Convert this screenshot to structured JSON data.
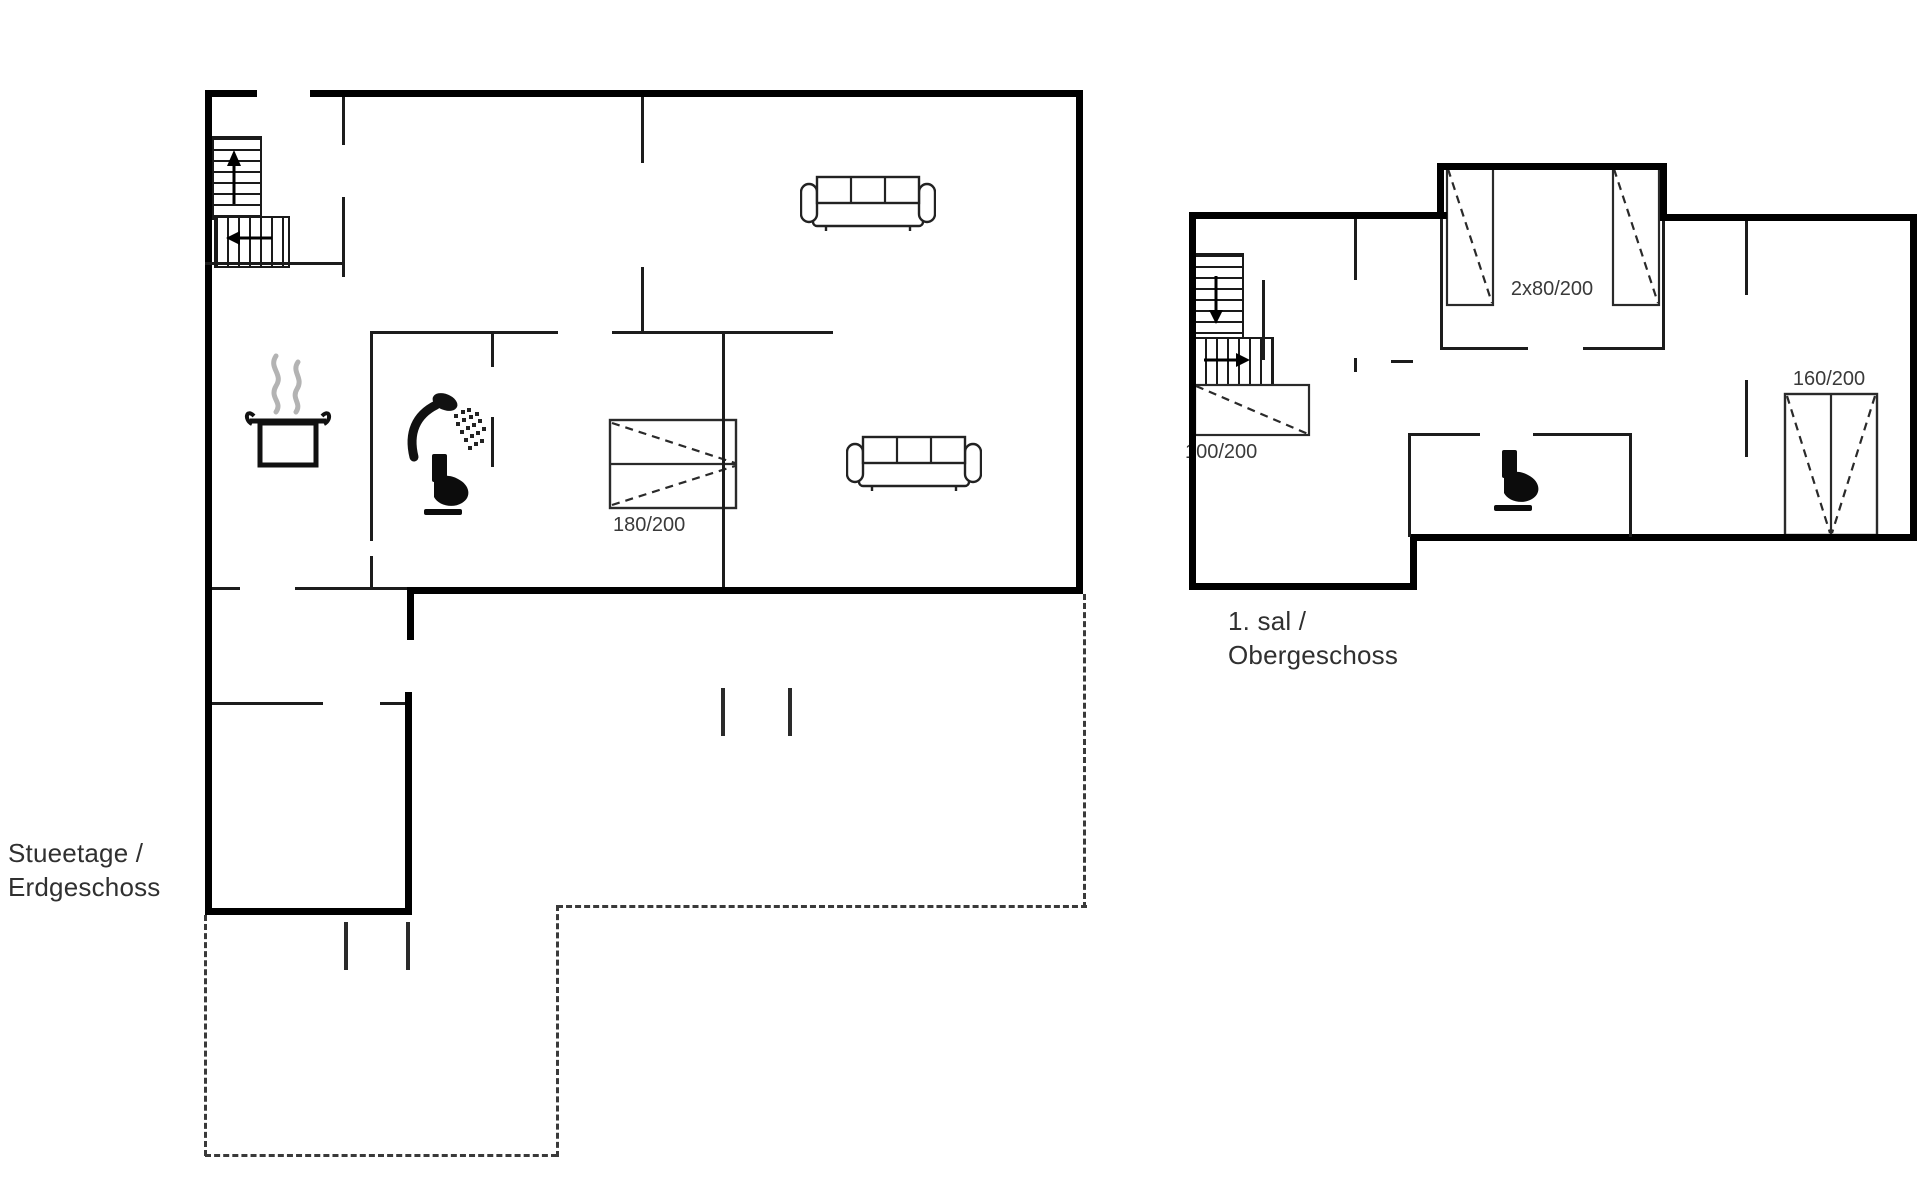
{
  "colors": {
    "background": "#ffffff",
    "exterior_wall": "#000000",
    "interior_wall": "#1c1c1c",
    "furniture_line": "#2a2a2a",
    "text": "#303030",
    "steam": "#b3b3b3",
    "terrace_dash": "#3a3a3a"
  },
  "ground_floor": {
    "name_line1": "Stueetage /",
    "name_line2": "Erdgeschoss",
    "double_bed_label": "180/200",
    "symbols": [
      "stairs-up-icon",
      "cooking-pot-icon",
      "shower-icon",
      "toilet-icon",
      "sofa-icon",
      "double-bed-icon",
      "terrace-dashed-outline"
    ]
  },
  "upper_floor": {
    "name_line1": "1. sal /",
    "name_line2": "Obergeschoss",
    "twin_beds_label": "2x80/200",
    "single_bed_label": "100/200",
    "double_bed_label": "160/200",
    "symbols": [
      "stairs-down-icon",
      "toilet-icon",
      "single-bed-icon",
      "twin-beds-icon",
      "double-bed-icon"
    ]
  }
}
